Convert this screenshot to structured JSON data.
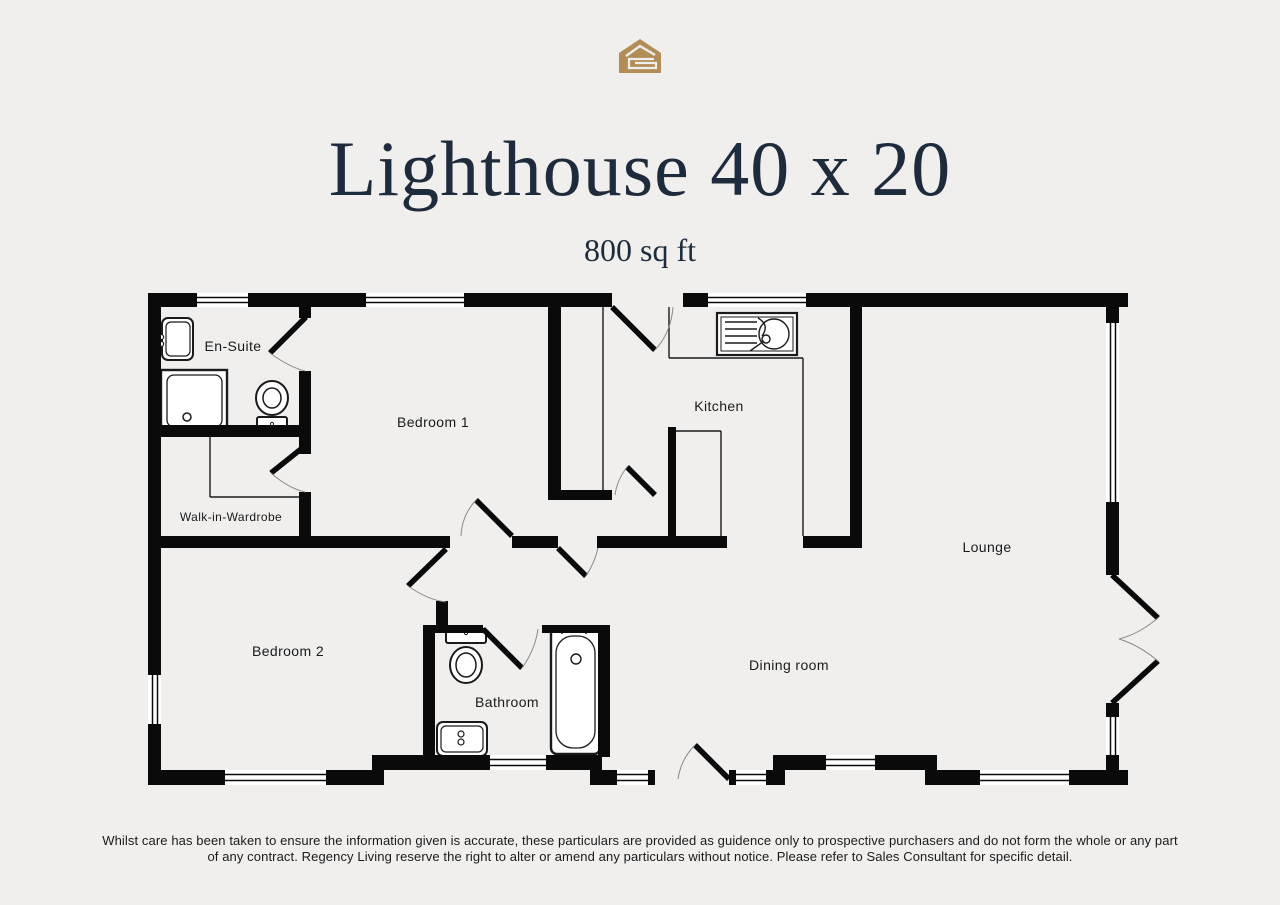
{
  "page": {
    "background_color": "#f0efee"
  },
  "logo": {
    "icon": "house-logo-icon",
    "color": "#b28d57"
  },
  "header": {
    "title": "Lighthouse 40 x 20",
    "subtitle": "800 sq ft",
    "text_color": "#1d2b3c"
  },
  "floorplan": {
    "wall_color": "#0a0a0a",
    "rooms": [
      {
        "label": "En-Suite"
      },
      {
        "label": "Bedroom 1"
      },
      {
        "label": "Kitchen"
      },
      {
        "label": "Walk-in-Wardrobe"
      },
      {
        "label": "Lounge"
      },
      {
        "label": "Bedroom 2"
      },
      {
        "label": "Bathroom"
      },
      {
        "label": "Dining room"
      }
    ]
  },
  "footer": {
    "disclaimer_line1": "Whilst care has been taken to ensure the information given is accurate, these particulars are provided as guidence only to prospective purchasers and do not form the whole or any part",
    "disclaimer_line2": "of any contract. Regency Living reserve the right to alter or amend any particulars without notice. Please refer to Sales Consultant for specific detail."
  }
}
